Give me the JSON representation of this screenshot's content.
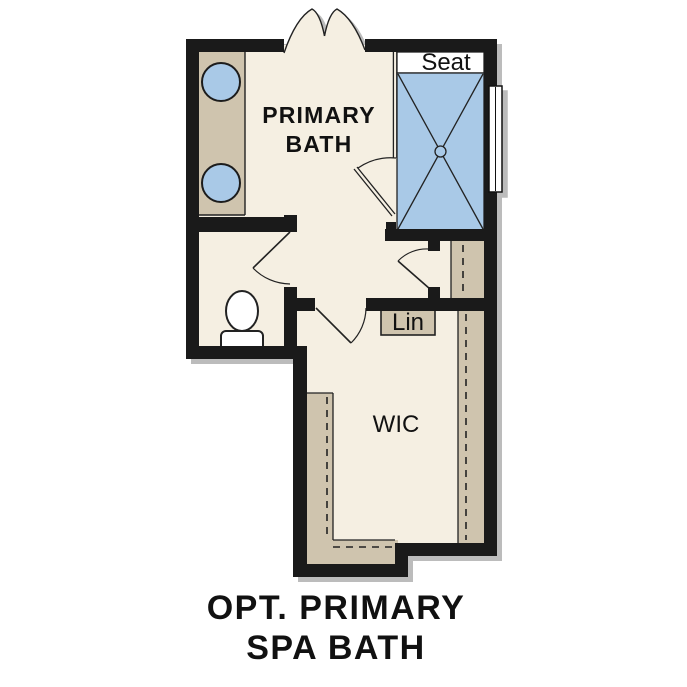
{
  "plan_title": {
    "line1": "OPT. PRIMARY",
    "line2": "SPA BATH"
  },
  "rooms": {
    "primary_bath": {
      "label_line1": "PRIMARY",
      "label_line2": "BATH"
    },
    "walk_in_closet": {
      "label": "WIC"
    }
  },
  "labels": {
    "shower_seat": "Seat",
    "linen_cabinet": "Lin"
  },
  "colors": {
    "wall": "#1a1a1a",
    "floor": "#f5efe2",
    "tile_blue": "#a9c9e7",
    "counter_tan": "#cfc4ae",
    "line": "#222222",
    "shadow": "#bcbcbc",
    "background": "#ffffff",
    "text": "#111111"
  }
}
